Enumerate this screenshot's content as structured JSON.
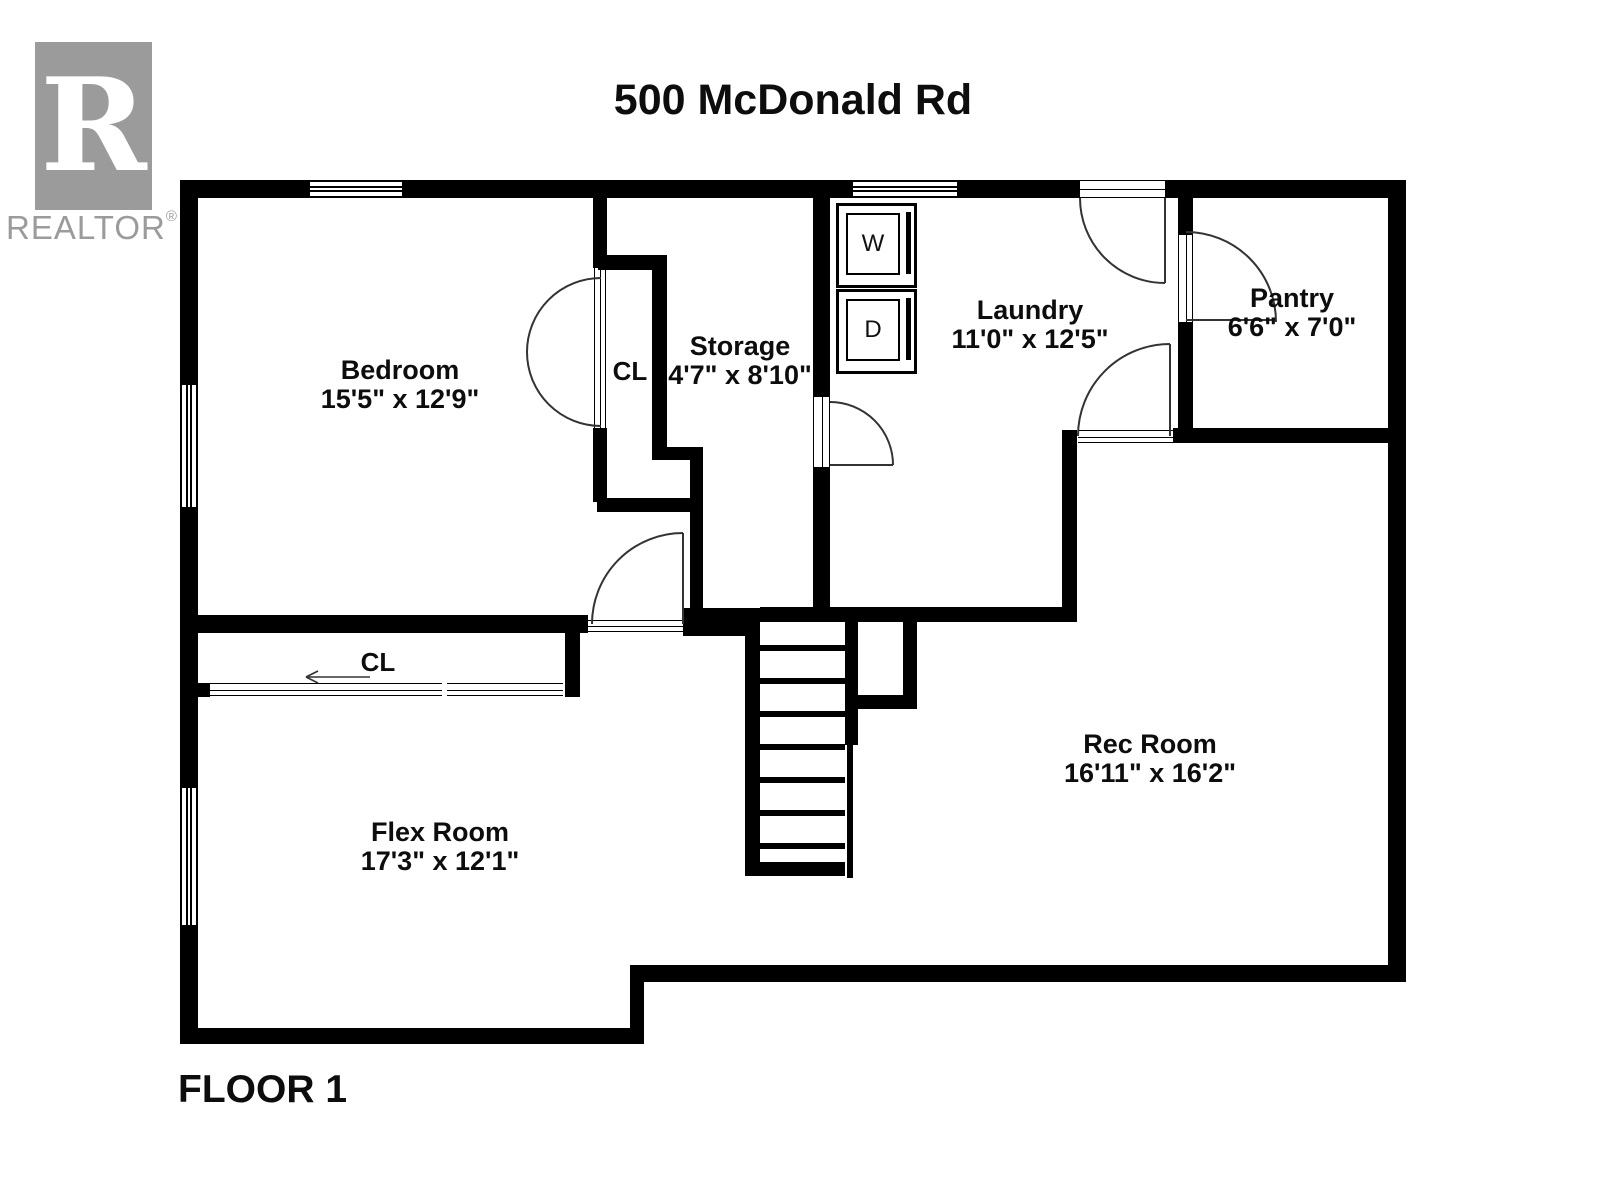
{
  "title": "500 McDonald Rd",
  "floor_label": "FLOOR 1",
  "logo": {
    "letter": "R",
    "brand": "REALTOR",
    "registered": "®"
  },
  "rooms": {
    "bedroom": {
      "name": "Bedroom",
      "dims": "15'5\" x 12'9\""
    },
    "bedroom_closet": {
      "name": "CL"
    },
    "storage": {
      "name": "Storage",
      "dims": "4'7\" x 8'10\""
    },
    "laundry": {
      "name": "Laundry",
      "dims": "11'0\" x 12'5\""
    },
    "pantry": {
      "name": "Pantry",
      "dims": "6'6\" x 7'0\""
    },
    "rec_room": {
      "name": "Rec Room",
      "dims": "16'11\" x 16'2\""
    },
    "flex_room": {
      "name": "Flex Room",
      "dims": "17'3\" x 12'1\""
    },
    "flex_closet": {
      "name": "CL"
    }
  },
  "appliances": {
    "washer": "W",
    "dryer": "D"
  },
  "colors": {
    "wall": "#000000",
    "logo_gray": "#9b9b9b",
    "label": "#0d0d0d"
  }
}
